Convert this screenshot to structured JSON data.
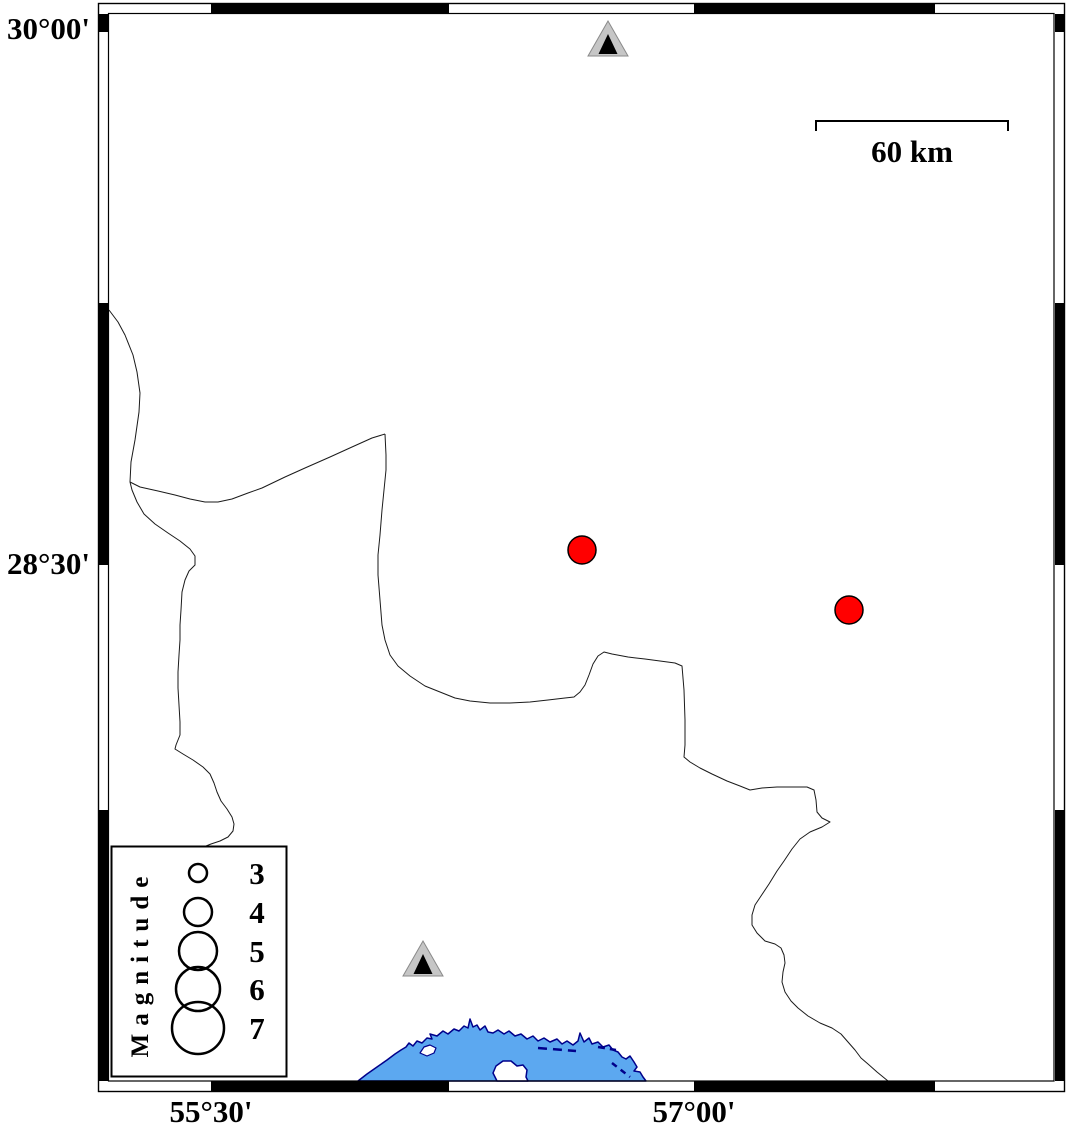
{
  "axis": {
    "left": [
      {
        "text": "30°00'"
      },
      {
        "text": "28°30'"
      }
    ],
    "bottom": [
      {
        "text": "55°30'"
      },
      {
        "text": "57°00'"
      }
    ]
  },
  "scale_bar": {
    "label": "60 km",
    "length_km": 60
  },
  "legend": {
    "title": "Magnitude",
    "circle_cx": 198,
    "label_cx": 257,
    "entries": [
      {
        "label": "3",
        "r": 9,
        "cy": 873
      },
      {
        "label": "4",
        "r": 14,
        "cy": 912
      },
      {
        "label": "5",
        "r": 19,
        "cy": 951
      },
      {
        "label": "6",
        "r": 22,
        "cy": 989
      },
      {
        "label": "7",
        "r": 26,
        "cy": 1028
      }
    ]
  },
  "markers": {
    "earthquakes": [
      {
        "x": 582,
        "y": 550,
        "r": 14
      },
      {
        "x": 849,
        "y": 610,
        "r": 14
      }
    ],
    "stations": [
      {
        "x": 608,
        "y": 40
      },
      {
        "x": 423,
        "y": 960
      }
    ]
  },
  "colors": {
    "earthquake_fill": "#ff0000",
    "earthquake_stroke": "#000000",
    "station_fill": "#c6c6c6",
    "station_edge": "#8a8a8a",
    "station_inner": "#000000",
    "sea_fill": "#5ca8f0",
    "coast_stroke": "#00008b",
    "frame": "#000000"
  }
}
